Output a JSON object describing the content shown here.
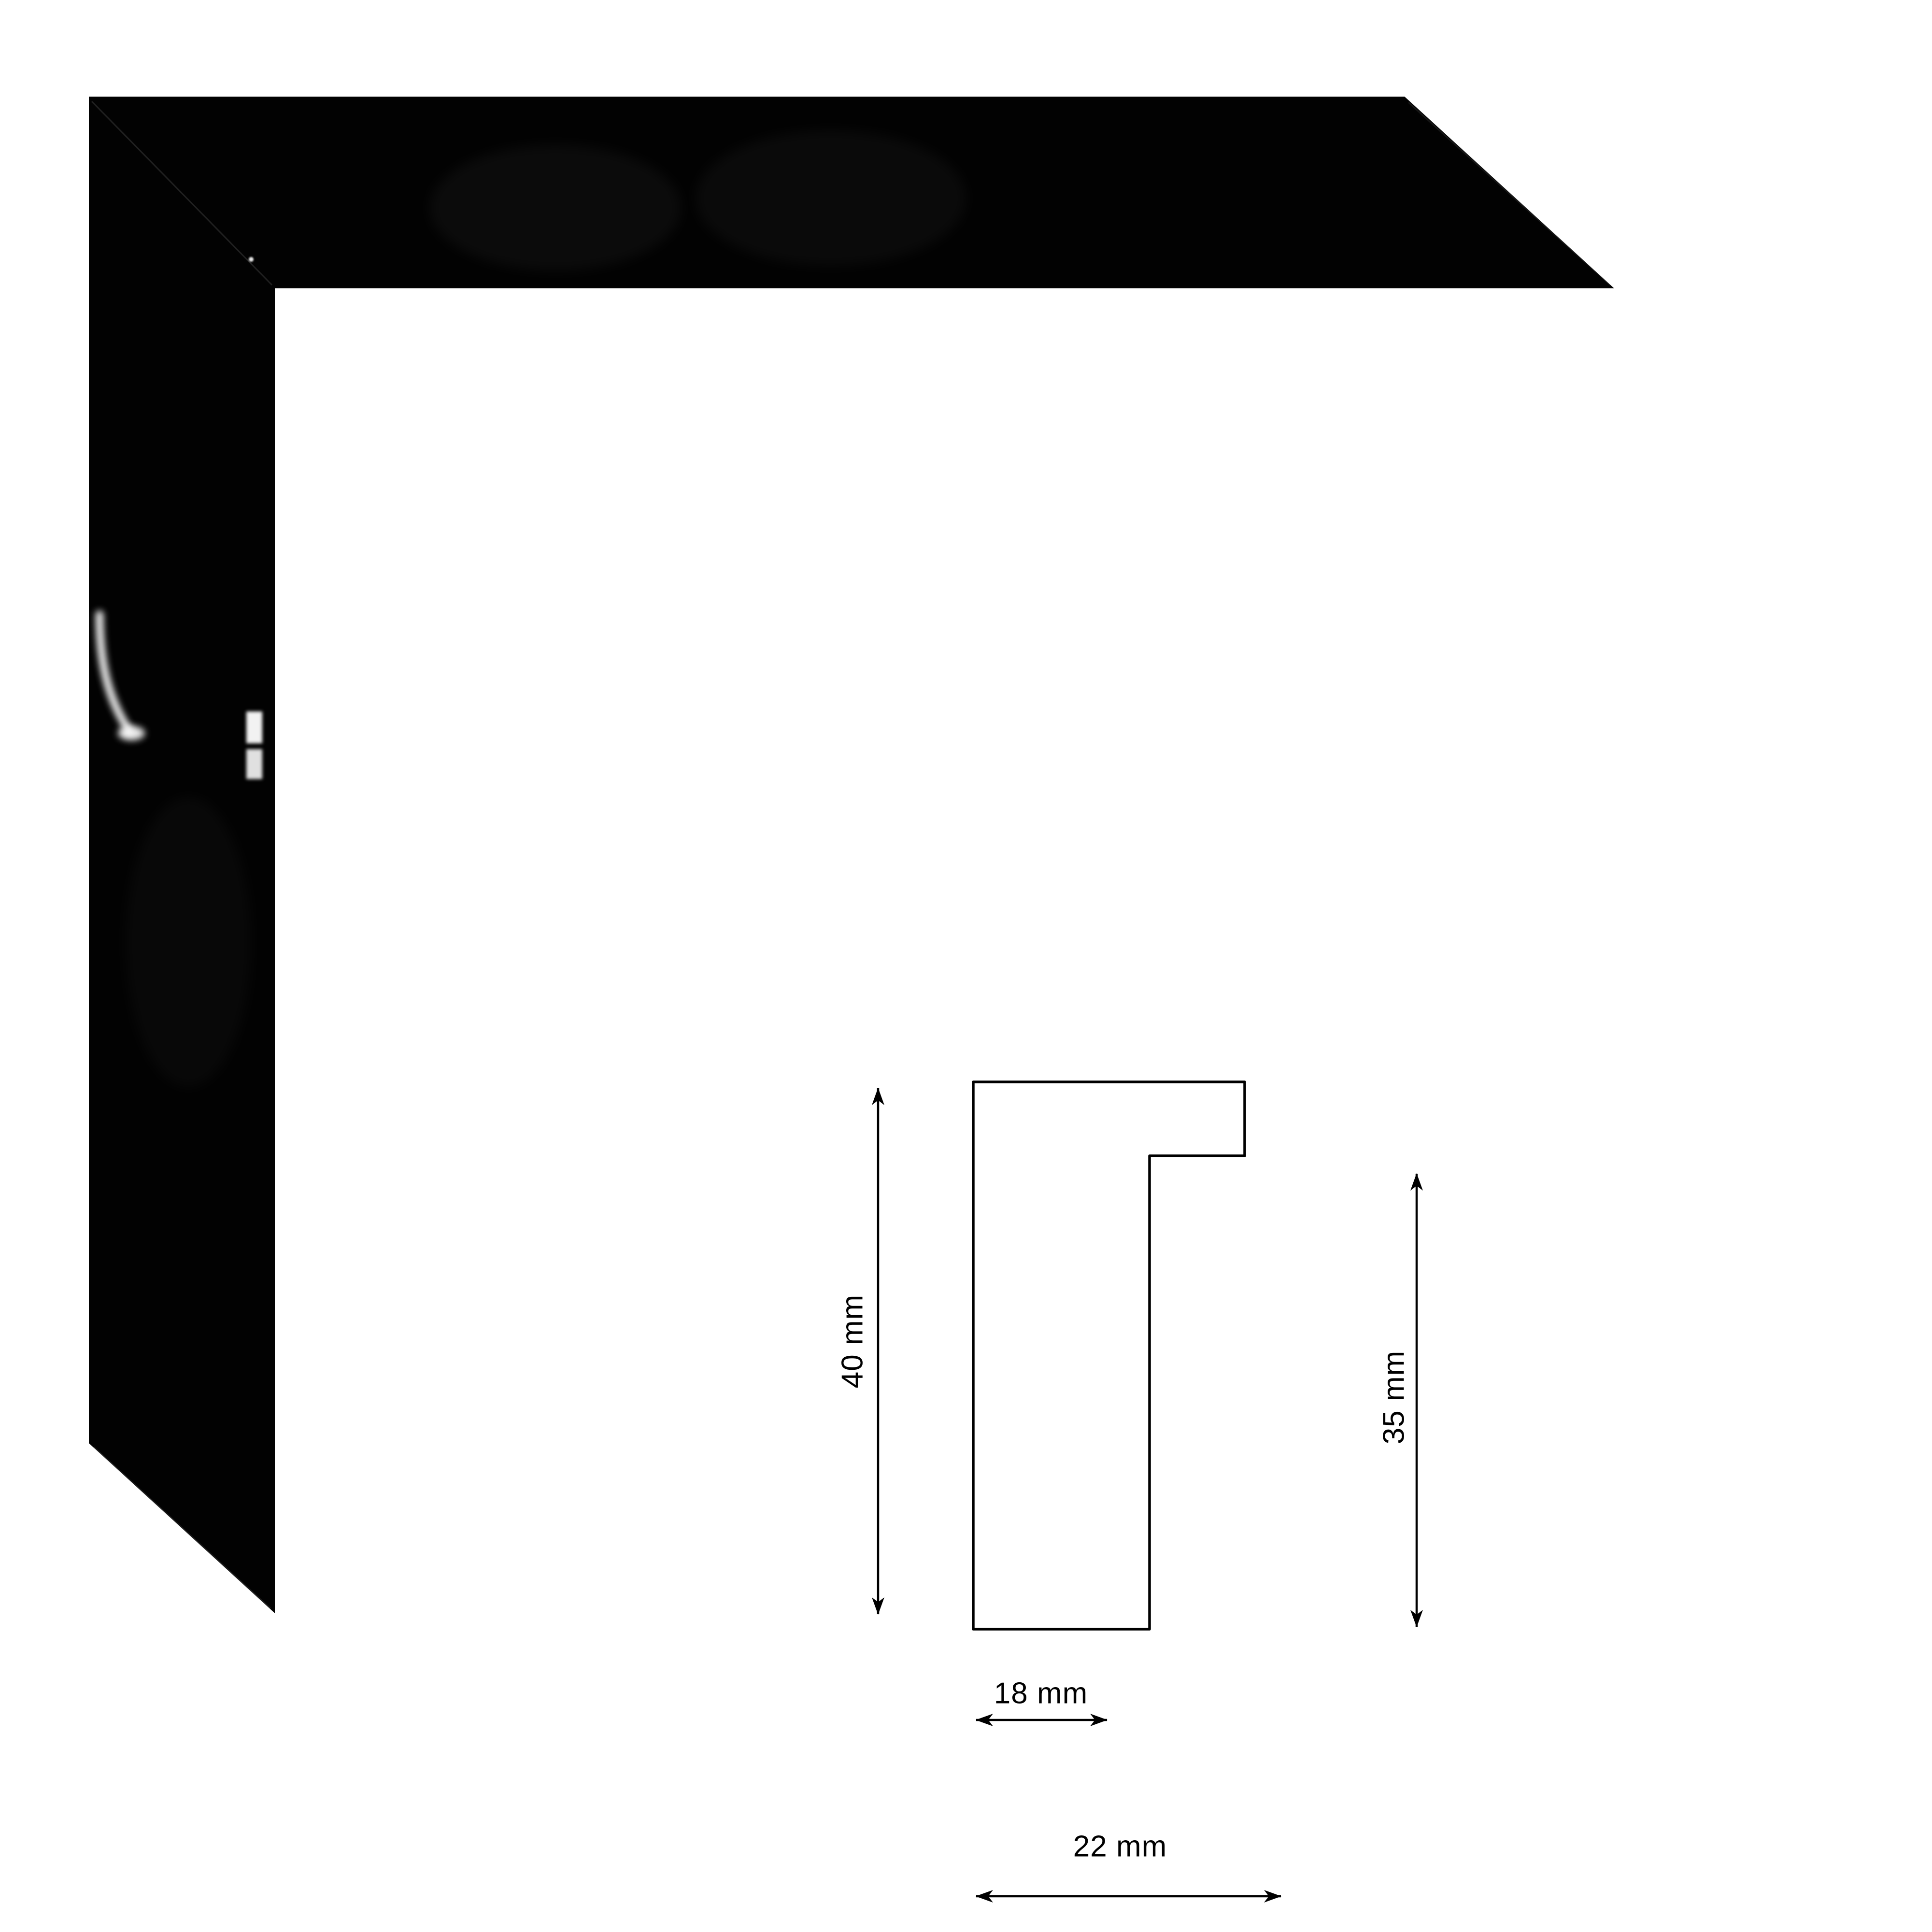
{
  "canvas": {
    "background_color": "#ffffff"
  },
  "frame_sample": {
    "color_hex": "#000000",
    "highlight_color_hex": "#ffffff"
  },
  "diagram": {
    "stroke_color_hex": "#000000",
    "labels": {
      "total_height": "40 mm",
      "inner_height": "35 mm",
      "body_width": "18 mm",
      "total_width": "22 mm"
    },
    "icons": {
      "vertical_dimension_icon": "double-headed-arrow-vertical",
      "horizontal_dimension_icon": "double-headed-arrow-horizontal"
    }
  }
}
